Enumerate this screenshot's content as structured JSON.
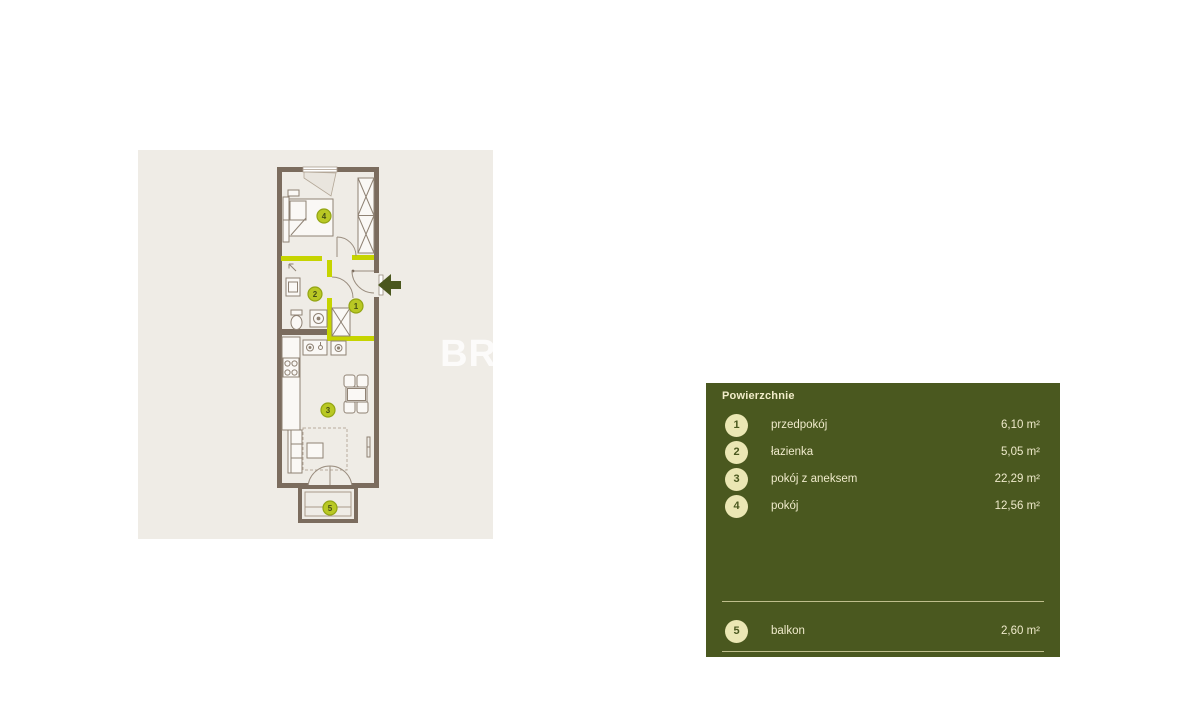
{
  "colors": {
    "page_background": "#ffffff",
    "plan_background": "#efece6",
    "wall": "#7b6c5e",
    "highlight_wall_lime": "#c6d400",
    "badge_fill": "#b9c824",
    "badge_border": "#93a513",
    "badge_text": "#454f16",
    "entrance_arrow": "#4a571e",
    "panel_background": "#4a581f",
    "panel_circle": "#ebe7b4",
    "panel_text": "#eee9c6"
  },
  "plan": {
    "watermark": "BR",
    "badges": [
      {
        "number": "1"
      },
      {
        "number": "2"
      },
      {
        "number": "3"
      },
      {
        "number": "4"
      },
      {
        "number": "5"
      }
    ]
  },
  "legend": {
    "title": "Powierzchnie",
    "rows": [
      {
        "num": "1",
        "label": "przedpokój",
        "area": "6,10 m²"
      },
      {
        "num": "2",
        "label": "łazienka",
        "area": "5,05 m²"
      },
      {
        "num": "3",
        "label": "pokój z aneksem",
        "area": "22,29 m²"
      },
      {
        "num": "4",
        "label": "pokój",
        "area": "12,56 m²"
      },
      {
        "num": "5",
        "label": "balkon",
        "area": "2,60 m²"
      }
    ]
  }
}
